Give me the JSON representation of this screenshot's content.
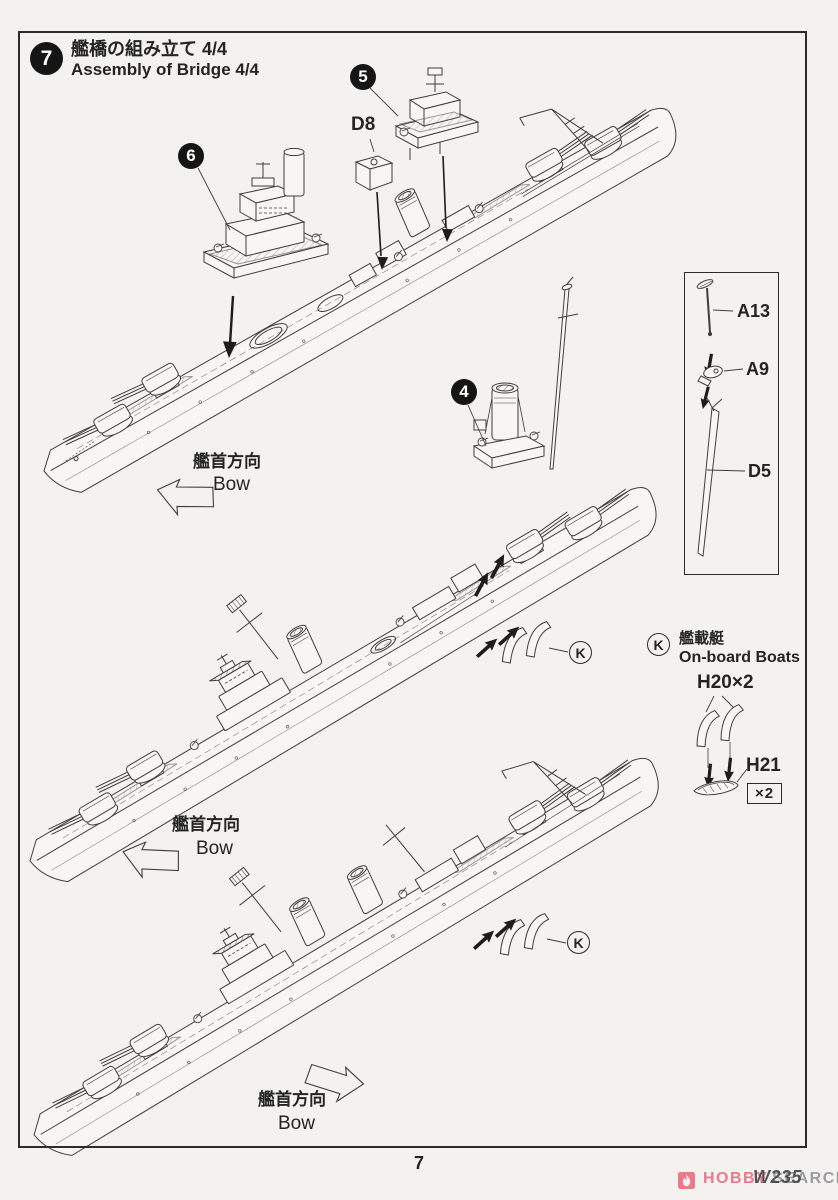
{
  "header": {
    "step_number": "7",
    "title_ja": "艦橋の組み立て 4/4",
    "title_en": "Assembly of Bridge 4/4"
  },
  "badges": {
    "six": "6",
    "five": "5",
    "four": "4"
  },
  "parts": {
    "d8": "D8",
    "a13": "A13",
    "a9": "A9",
    "d5": "D5",
    "h20": "H20×2",
    "h21": "H21",
    "h21_qty": "×2"
  },
  "boats_legend": {
    "letter": "K",
    "title_ja": "艦載艇",
    "title_en": "On-board Boats"
  },
  "ship_callouts": {
    "k1": "K",
    "k2": "K"
  },
  "bow_label": {
    "ja": "艦首方向",
    "en": "Bow"
  },
  "footer": {
    "page_number": "7",
    "kit_code": "W235",
    "brand_1": "HOBBY",
    "brand_2": "SEARCH"
  },
  "colors": {
    "ink": "#3e3e3e",
    "accent_pink": "#e87a8c",
    "watermark_gray": "#9b9ba2",
    "paper": "#f3f2ef"
  }
}
